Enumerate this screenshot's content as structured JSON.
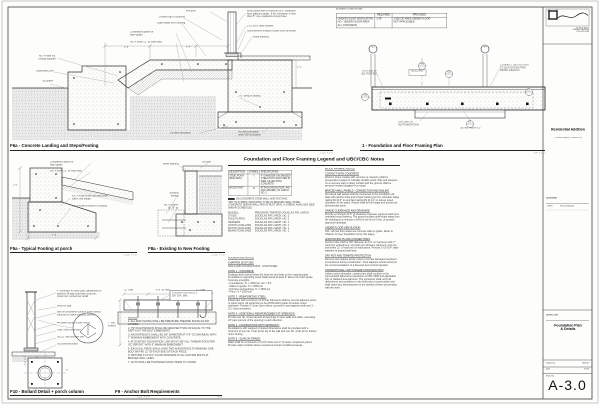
{
  "titleblock": {
    "firm_address": "415 Main Street\nOakland, CA 94610\nt 510.555.0199",
    "project_name": "Residential Addition",
    "project_address": "( Private Residence, Oakland CA )",
    "submittal_label": "Submittal:",
    "submittal_date": "1/7/19",
    "submittal_desc": "Permit Submittal",
    "sheet_title_label": "Sheet Title",
    "sheet_title": "Foundation Plan\n& Details",
    "project_no_label": "Project No.",
    "project_no": "1808.01",
    "date_label": "Date",
    "date_value": "1/7/19",
    "sheet_no_label": "Sheet No.",
    "sheet_no": "A-3.0"
  },
  "vent_table": {
    "caption": "(N) DINING & LIVING ROOMS",
    "col_required": "REQUIRED",
    "col_provided": "PROVIDED",
    "row_label": "UNDER FLOOR VENTILATION\nNO - UNDER FLOOR AREA\nALL CONCRETE",
    "required": "2 SF",
    "provided": "1/150 OF AREA UNDER FLOOR\nNOT APPLICABLE"
  },
  "details": {
    "f6a": {
      "title": "F6a - Concrete Landing and Steps/Footing",
      "scale": "1 1/2\" = 1'-0\""
    },
    "plan": {
      "title": "1 - Foundation and Floor Framing Plan",
      "scale": "1/4\" = 1'-0\""
    },
    "f5a": {
      "title": "F5a - Typical Footing at porch",
      "scale": "1 1/2\" = 1'-0\""
    },
    "f8a": {
      "title": "F8a - Existing to New Footing",
      "scale": "1 1/2\" = 1'-0\""
    },
    "f10": {
      "title": "F10 - Bollard Detail + porch column",
      "scale": "1 1/2\" = 1'-0\""
    },
    "f9": {
      "title": "F9 - Anchor Bolt Requirements",
      "scale": "NTS"
    }
  },
  "legend": {
    "header": "Foundation and Floor Framing Legend and UBC/CBC Notes",
    "table": {
      "h_desc": "DESCRIPTION",
      "h_sym": "SYMBOL",
      "h_spec": "SPECIFICATION",
      "rows": [
        {
          "desc": "STEEL POINT (BOLLARD)",
          "sym": "○",
          "spec": "4\" DIAMETER GALVANIZED STEEL POST GROUTED IN PIER, FILLED WITH CONCRETE"
        },
        {
          "desc": "WOOD POST",
          "sym": "⊙",
          "spec": "ATTACH WOOD POST, 4X6 (OR LARGER), DF LARCH NO. 2"
        }
      ]
    },
    "wall_swatch_label": "(N) CONCRETE STEM WALL AND FOOTING",
    "wall_notes": "\"W#\" IN SYMBOL INDICATES TYPE OF BRACED WALL PANEL\nCONCRETE SHEAR WALL PER STRUCTURAL / LATERAL ANALYSIS (SEE SHEAR SCHEDULE)",
    "materials": [
      {
        "k": "MUDSILL",
        "v": "PRESSURE TREATED DOUGLAS FIR, LARCH"
      },
      {
        "k": "STUDS",
        "v": "DOUGLAS FIR LARCH, NO. 2"
      },
      {
        "k": "SOLE PLATES",
        "v": "DOUGLAS FIR LARCH, NO. 2"
      },
      {
        "k": "HEADERS",
        "v": "DOUGLAS FIR LARCH, NO. 1"
      },
      {
        "k": "JOISTS (OAKLAND)",
        "v": "DOUGLAS FIR LARCH, NO. 2"
      },
      {
        "k": "POSTS (OAKLAND)",
        "v": "DOUGLAS FIR LARCH, NO. 1"
      },
      {
        "k": "BEAMS (OAKLAND)",
        "v": "DOUGLAS FIR LARCH, NO. 1"
      }
    ]
  },
  "notes_left": [
    {
      "h": "FOUNDATION NOTES",
      "t": ""
    },
    {
      "h": "CHAPTER 18 OF CBC",
      "t": "SOILS AND FOUNDATIONS - CONTINUED"
    },
    {
      "h": "NOTE 1 - CONCRETE:",
      "t": "Footings shall extend below the frost line and bear on firm natural grade. Foundations supporting wood shall extend at least 6\" above the finish grade.\nConcrete strengths:\n- Foundations:  f'c = 2500 psi, w/c = 0.5\n- Slabs on grade:  f'c = 2500 psi\n- Porches and landings:  f'c = 2500 psi\n- Piers:  f'c = 2500 psi"
    },
    {
      "h": "NOTE 2 - REINFORCING STEEL:",
      "t": "Rebar laps with a minimum of 40 bar diameters shall be used at adjacent pours or splice joints. All reinforcing to be ASTM A615 grade 40 unless noted otherwise. Provide 3\" clear cover where concrete is cast against earth and 1-1/2\" clear elsewhere."
    },
    {
      "h": "NOTE 3 - ADDITIONAL REINFORCEMENT AT OPENINGS:",
      "t": "Provide two No. 4 bars around all openings in stem walls and slabs, extending 24\" past corners of the opening in each direction."
    },
    {
      "h": "NOTE 4 - FOUNDATIONS WITH SETBACKS:",
      "t": "Foundations with stepped or sloped dimensions shall be provided with a minimum of one No. 4 bar at the top of the wall and one No. 4 bar at the bottom of the footing."
    },
    {
      "h": "NOTE 5 - SLAB ON GRADE:",
      "t": "Slabs shall be a minimum of 3-1/2\" thick over 4\" of clean compacted gravel. Provide vapor retarder where required at interior conditioned areas."
    }
  ],
  "notes_right": [
    {
      "h": "WOOD FRAMING NOTES",
      "t": ""
    },
    {
      "h": "CONTACT WITH CONCRETE",
      "t": "Wood in direct contact with concrete or masonry shall be preservative treated or naturally durable wood. Sills and sleepers on a concrete slab in direct contact with the ground shall be pressure treated douglas fir or equal."
    },
    {
      "h": "BRACED WALL PANELS - CONNECTION AND NAILING",
      "t": "All braced wall panels shall be connected to the foundation sill plate with anchor bolts and to floor framing per the schedule. Edge nailing 8d @ 6\" oc and field nailing 8d @ 12\" oc unless noted otherwise on the plans. Panels shall be full height and blocked at all horizontal joints."
    },
    {
      "h": "GRADE CLEARANCE AND DRAINAGE",
      "t": "Provide a minimum of 6\" of clearance between exposed earth and untreated wood framing. The ground surface shall slope away from the building at a minimum of 5% for the first 10 feet, or provide approved drainage."
    },
    {
      "h": "UNDER FLOOR VENTILATION",
      "t": "N/A - all new floor areas are concrete slab on grade. Refer to Chapter 12 (see foundation terms this page)."
    },
    {
      "h": "ANCHOR BOLTS AND CONNECTIONS",
      "t": "Anchor bolts shall be 5/8\" diameter at 4'-0\" oc maximum with 7\" minimum embedment, two bolts per sill piece minimum, and one bolt within 12\" of each end of each piece. Provide 3\"x3\"x1/4\" plate washers at braced wall lines."
    },
    {
      "h": "DRY ROT AND TERMITE PROTECTION",
      "t": "Remove and replace all dry rotted or termite damaged members encountered during construction. Treat adjacent sound wood per the recommendations of a licensed pest control operator."
    },
    {
      "h": "CONVENTIONAL LIGHT-FRAME CONSTRUCTION",
      "t": "Unless noted otherwise, construction shall conform to the conventional light-frame provisions of CBC 2308 and applicable City of Oakland amendments. The contractor shall verify all dimensions and conditions in the field prior to construction and shall report any discrepancies to the architect before proceeding with the work."
    }
  ],
  "f9_notes_label": "NOTES:",
  "f9_notes": [
    "1.  ALL MUD PLATES SHALL BE PRESSURE TREATED DOUGLAS FIR LUMBER.",
    "2.  TIP OF EXTENSION SHALL BE GREATER THAN OR EQUAL TO THE DEPTH OF THE BOLT EMBEDMENT.",
    "3.  ANCHOR BOLTS SHALL BE 5/8\" DIAMETER AT 4'-0\" OC MAXIMUM, WITH 7\" MINIMUM EMBEDMENT INTO CONCRETE.",
    "4.  AT EXISTING FOUNDATION, USE EPOXY-SET ALL-THREAD RODS PER ICC REPORT, WITH 5\" MINIMUM EMBEDMENT.",
    "5.  EACH SILL PIECE SHALL HAVE TWO ANCHOR BOLTS MINIMUM; ONE BOLT WITHIN 12\" OF EACH END OF EACH PIECE.",
    "6.  PROVIDE 3\"x3\"x1/4\" PLATE WASHERS AT ALL ANCHOR BOLTS AT BRACED WALL LINES.",
    "7.  NUTS SHALL BE TIGHTENED SNUG PRIOR TO COVER."
  ],
  "callouts": [
    {
      "x": 22,
      "y": 55,
      "w": 80,
      "ta": "right",
      "t": "No. 4 rebar ea.\nnosing (typical)"
    },
    {
      "x": 24,
      "y": 70,
      "w": 70,
      "ta": "right",
      "t": "Expansion joint"
    },
    {
      "x": 30,
      "y": 80,
      "w": 55,
      "ta": "right",
      "t": "(E) grade"
    },
    {
      "x": 186,
      "y": 10,
      "w": 60,
      "t": "4x4 post"
    },
    {
      "x": 143,
      "y": 16,
      "w": 100,
      "ta": "right",
      "t": "Cement top of concrete"
    },
    {
      "x": 139,
      "y": 22,
      "w": 110,
      "ta": "right",
      "t": "Slope away from building"
    },
    {
      "x": 247,
      "y": 10,
      "w": 200,
      "t": "Wood posts with a minimum of 8\" clearance\nfrom adjacent grade. If the clearance is less\nthan 8\", use a galvanized post base"
    },
    {
      "x": 247,
      "y": 25,
      "w": 150,
      "t": "2\"x2\"x3/8\" plate washer"
    },
    {
      "x": 247,
      "y": 30,
      "w": 190,
      "t": "Non-pressure treated mudsill over sill sealer"
    },
    {
      "x": 253,
      "y": 36,
      "w": 120,
      "t": "Metal flashing"
    },
    {
      "x": 130,
      "y": 31,
      "w": 110,
      "t": "Compacted gravel or\nbase grade"
    },
    {
      "x": 130,
      "y": 41,
      "w": 130,
      "t": "No. 4 rebar 12\" oc each way"
    },
    {
      "x": 170,
      "y": 132,
      "w": 110,
      "t": "(N) wall foundation"
    },
    {
      "x": 238,
      "y": 131,
      "w": 110,
      "t": "(N) wall foundation\nunder (E) foundation"
    },
    {
      "x": 124,
      "y": 46,
      "w": 40,
      "t": "2'-8\""
    },
    {
      "x": 186,
      "y": 46,
      "w": 40,
      "t": "3'-4\""
    },
    {
      "x": 238,
      "y": 95,
      "w": 90,
      "t": "2'-0\" deep of footing"
    },
    {
      "x": 297,
      "y": 66,
      "w": 40,
      "t": "1'-0\""
    },
    {
      "x": 50,
      "y": 161,
      "w": 110,
      "t": "Compacted gravel or\nbase grade"
    },
    {
      "x": 50,
      "y": 170,
      "w": 130,
      "t": "No. 4 rebar 12\" oc each way"
    },
    {
      "x": 72,
      "y": 195,
      "w": 140,
      "t": "No. 4 rebar at the top and at the\nslab's mid height"
    },
    {
      "x": 72,
      "y": 205,
      "w": 150,
      "t": "No. 4 rebar at bottom of footing"
    },
    {
      "x": 13,
      "y": 184,
      "w": 30,
      "t": "2'-0\""
    },
    {
      "x": 52,
      "y": 234,
      "w": 30,
      "t": "1'-6\""
    },
    {
      "x": 149,
      "y": 163,
      "w": 70,
      "ta": "right",
      "t": "Metal flashing"
    },
    {
      "x": 149,
      "y": 192,
      "w": 70,
      "ta": "right",
      "t": "Existing\nfooting"
    },
    {
      "x": 149,
      "y": 204,
      "w": 70,
      "ta": "right",
      "t": "No. 4 dowels\n@ 16\" oc"
    },
    {
      "x": 202,
      "y": 161,
      "w": 60,
      "t": "(N) slab"
    },
    {
      "x": 57,
      "y": 290,
      "w": 200,
      "t": "4\" schedule 40 steel pipe, galvanized or\npainted; fill pipe solid with concrete;\ncrown top; embed per detail"
    },
    {
      "x": 57,
      "y": 305,
      "w": 140,
      "t": "Weld-on cap"
    },
    {
      "x": 57,
      "y": 311,
      "w": 200,
      "t": "Bolt-on decorative column cover (wood\ncolumn) to match existing, painted"
    },
    {
      "x": 57,
      "y": 322,
      "w": 160,
      "t": "#4 dowel center to pier below"
    },
    {
      "x": 57,
      "y": 329,
      "w": 140,
      "t": "Galv. insert to anchor"
    },
    {
      "x": 57,
      "y": 336,
      "w": 140,
      "t": "(N) 12\" dia concrete pier"
    },
    {
      "x": 57,
      "y": 343,
      "w": 140,
      "t": "(N) concrete porch"
    },
    {
      "x": 66,
      "y": 369,
      "w": 40,
      "t": "8\""
    },
    {
      "x": 38,
      "y": 390,
      "w": 40,
      "t": "1'-0\""
    },
    {
      "x": 124,
      "y": 289,
      "w": 40,
      "t": "12\" max"
    },
    {
      "x": 156,
      "y": 289,
      "w": 60,
      "t": "4'-0\" oc max"
    },
    {
      "x": 196,
      "y": 289,
      "w": 40,
      "t": "12\" max"
    },
    {
      "x": 108,
      "y": 322,
      "w": 34,
      "t": "7\" min\nembed"
    },
    {
      "x": 172,
      "y": 291.5,
      "w": 95,
      "t": "FOUNDATION BOLTS\n5/8\" DIA. MIN."
    },
    {
      "x": 352,
      "y": 70,
      "w": 60,
      "ta": "right",
      "t": "OUTLINE OF\n(E) FOOTING"
    },
    {
      "x": 500,
      "y": 64,
      "w": 100,
      "t": "CONNECT (N) FOOTING\nTO (E) FOOTING PER\nDETAIL F6a/A3.0"
    },
    {
      "x": 398,
      "y": 121,
      "w": 90,
      "t": "OUTLINE OF\n(N) FOUNDATION"
    },
    {
      "x": 460,
      "y": 127,
      "w": 90,
      "t": "DETAIL F6a/A-3.0"
    },
    {
      "x": 417.4,
      "y": 63.4,
      "w": 22,
      "ta": "center",
      "t": "F6a"
    },
    {
      "x": 444.4,
      "y": 71.4,
      "w": 22,
      "ta": "center",
      "t": "F10"
    },
    {
      "x": 360.4,
      "y": 94.4,
      "w": 22,
      "ta": "center",
      "t": "F5a"
    },
    {
      "x": 465.4,
      "y": 121.4,
      "w": 22,
      "ta": "center",
      "t": "F9"
    },
    {
      "x": 524.4,
      "y": 89.4,
      "w": 22,
      "ta": "center",
      "t": "B1"
    },
    {
      "x": 368,
      "y": 46.4,
      "w": 24,
      "ta": "center",
      "t": "N2"
    },
    {
      "x": 480,
      "y": 46.4,
      "w": 24,
      "ta": "center",
      "t": "N4"
    },
    {
      "x": 409,
      "y": 70.3,
      "w": 40,
      "ta": "center",
      "t": "BOLLARD"
    }
  ]
}
